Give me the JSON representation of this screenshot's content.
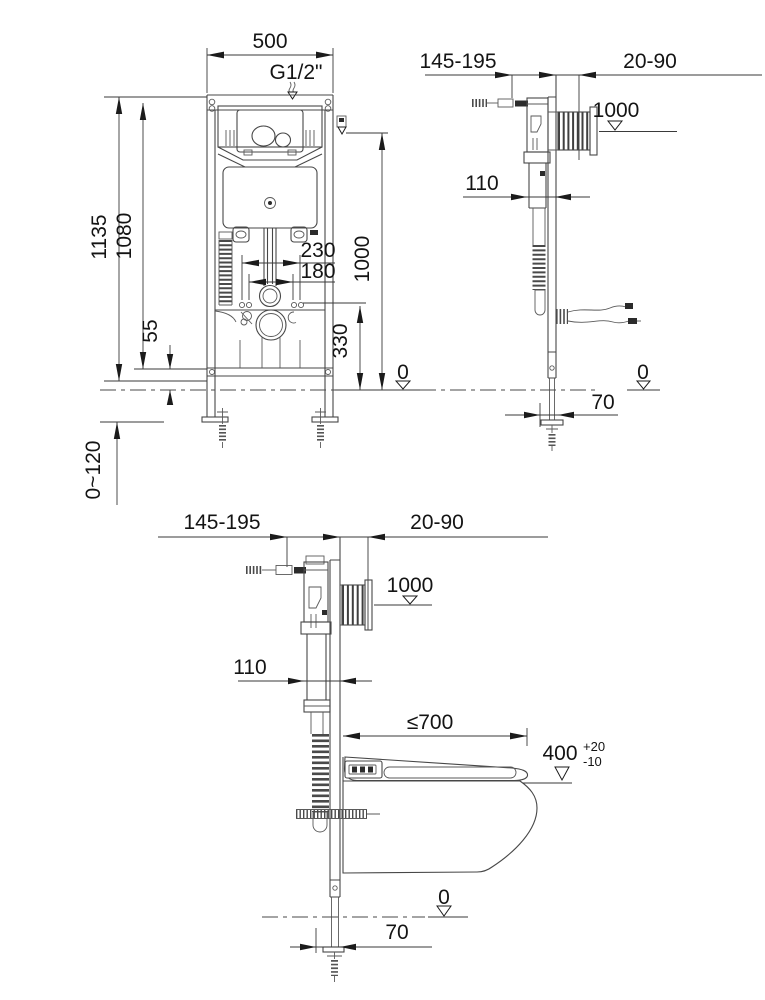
{
  "drawing_title": "concealed-cistern wall-hung toilet installation dimensions (mm)",
  "front_view": {
    "frame_width": "500",
    "water_supply": "G1/2\"",
    "total_height": "1135",
    "frame_height": "1080",
    "outer_stud_spacing": "230",
    "inner_stud_spacing": "180",
    "actuator_height": "1000",
    "outlet_height": "330",
    "lower_rail_height": "55",
    "floor_level": "0",
    "foot_adjustment": "0~120"
  },
  "side_view": {
    "frame_depth_range": "145-195",
    "wall_thickness_range": "20-90",
    "actuator_height": "1000",
    "cistern_depth": "110",
    "floor_level": "0",
    "anchor_offset": "70"
  },
  "installed_view": {
    "frame_depth_range": "145-195",
    "wall_thickness_range": "20-90",
    "actuator_height": "1000",
    "cistern_depth": "110",
    "bowl_length_max": "≤700",
    "seat_height": "400",
    "seat_height_tol_upper": "+20",
    "seat_height_tol_lower": "-10",
    "floor_level": "0",
    "anchor_offset": "70"
  }
}
